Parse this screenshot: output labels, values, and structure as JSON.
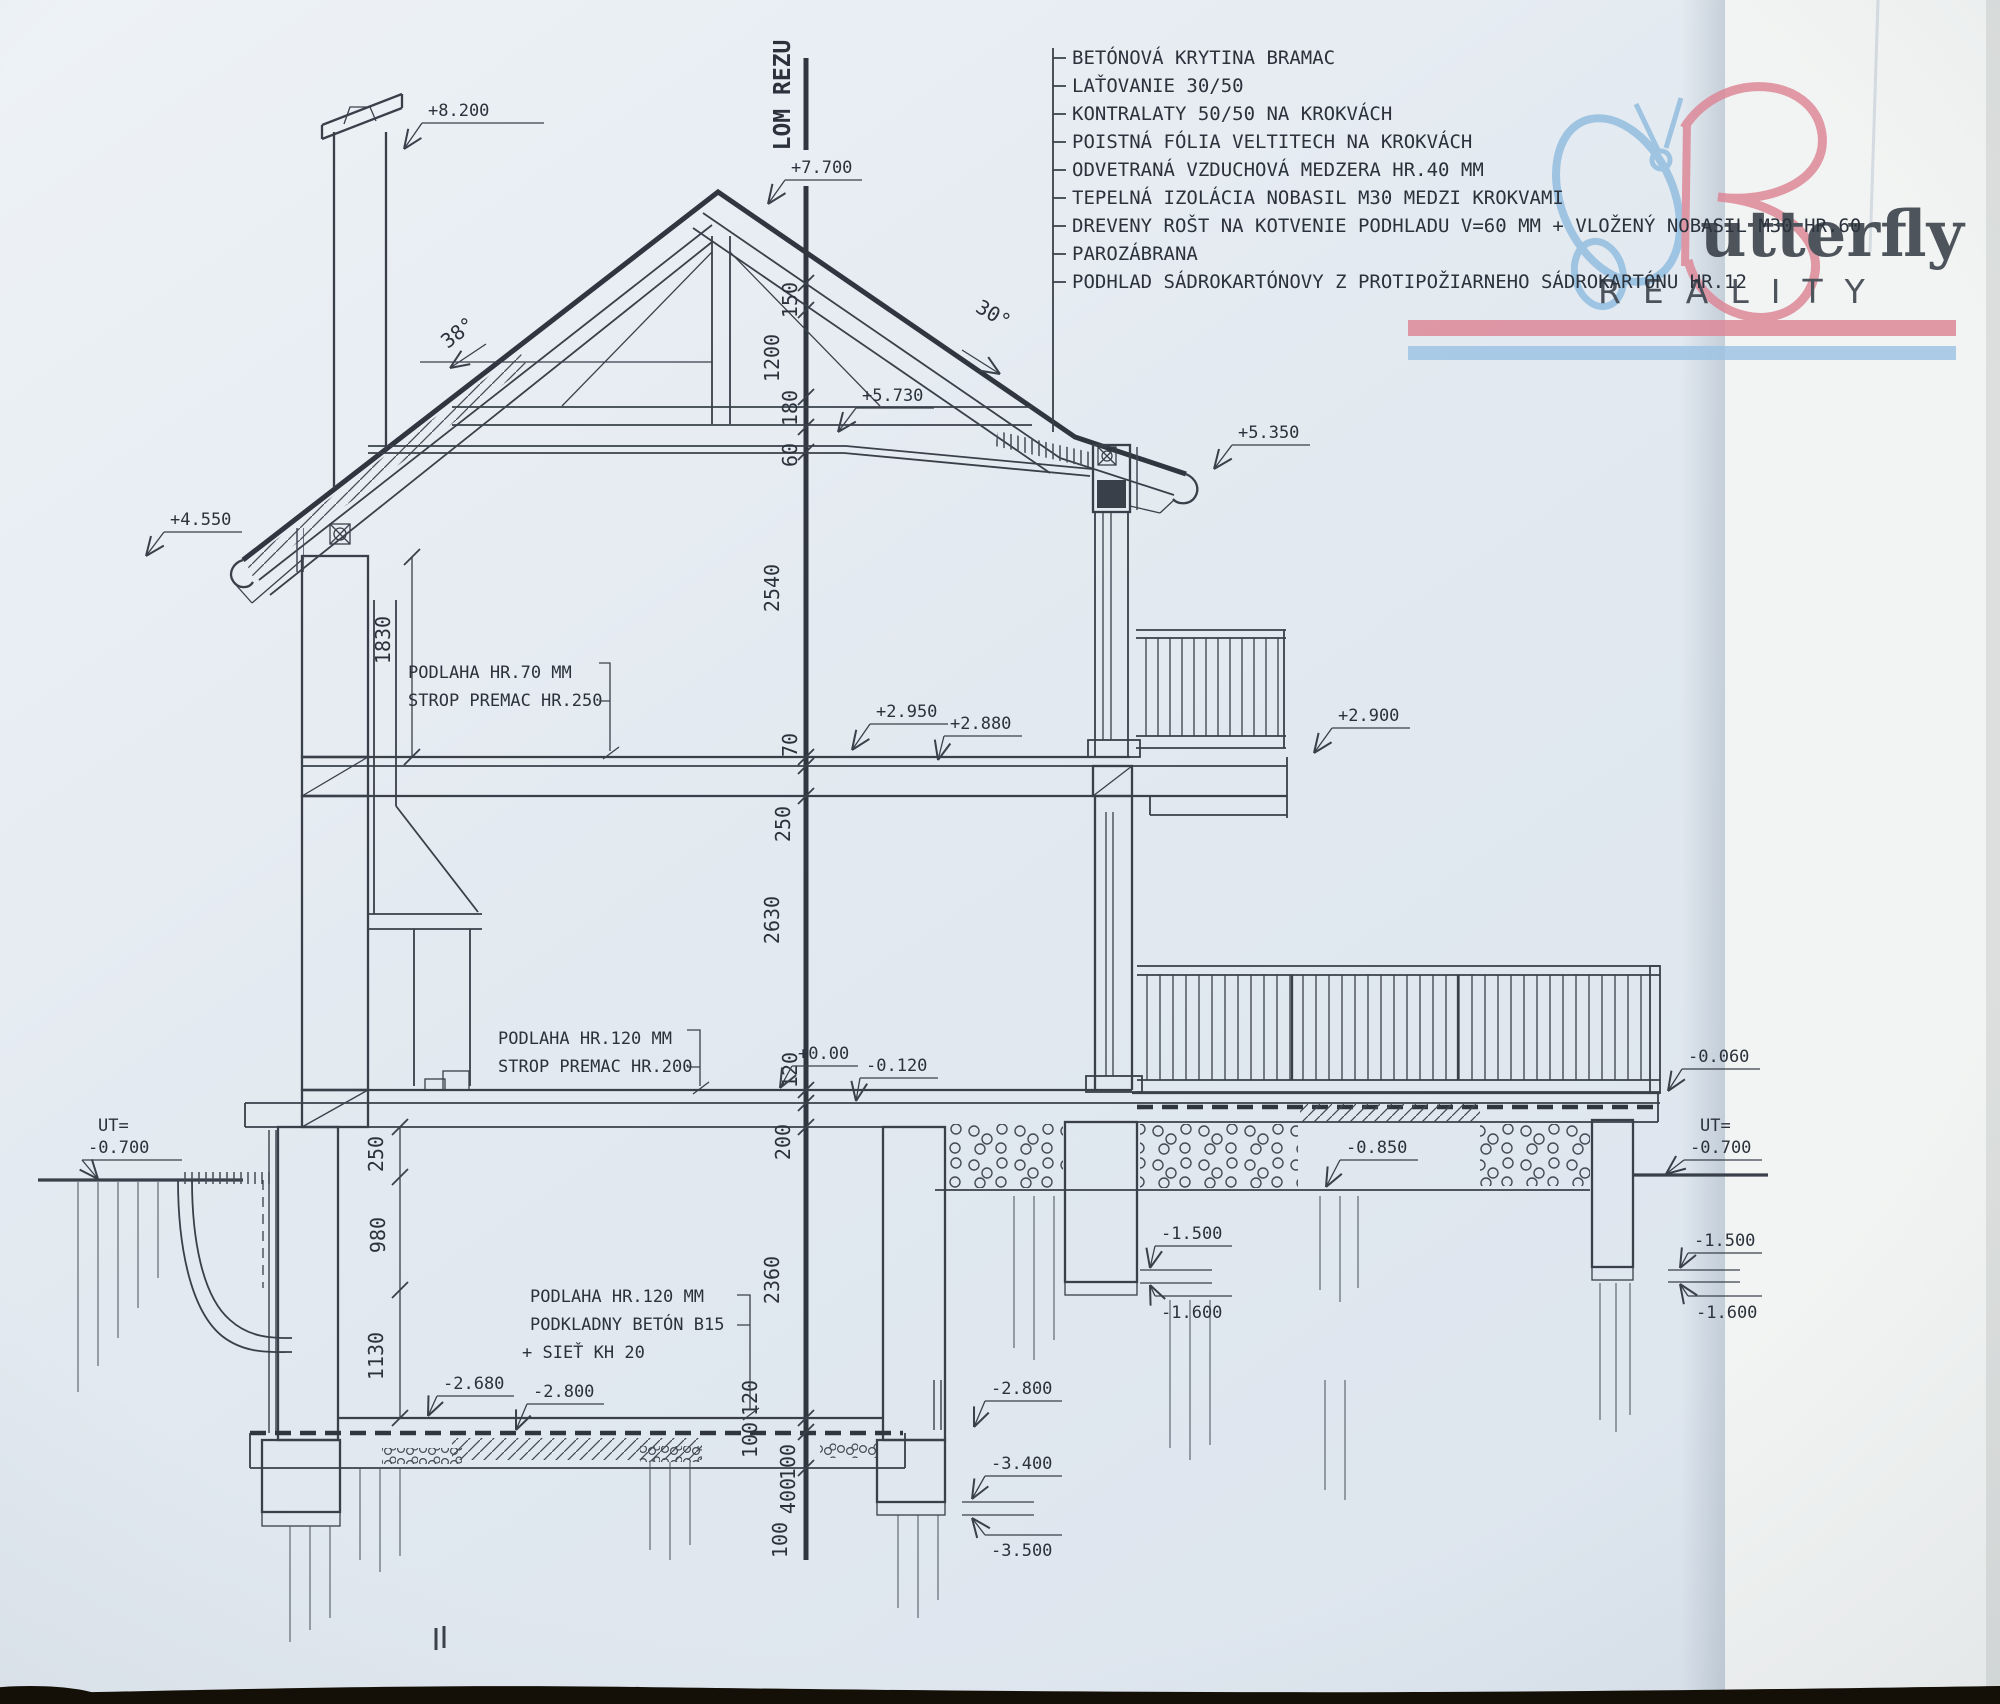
{
  "document": {
    "type": "architectural-section-drawing",
    "section_label": "LOM REZU"
  },
  "colors": {
    "ink": "#39404a",
    "text": "#2b323c",
    "paper": "#e4eaf1",
    "paper_fold": "#f2f4f3",
    "logo_pink": "#dd8595",
    "logo_blue": "#8fbcdf",
    "photo_edge": "#141008"
  },
  "logo": {
    "wordmark": "utterfly",
    "subtitle": "REALITY"
  },
  "roof_layers": [
    "BETÓNOVÁ KRYTINA BRAMAC",
    "LAŤOVANIE 30/50",
    "KONTRALATY 50/50 NA KROKVÁCH",
    "POISTNÁ FÓLIA VELTITECH NA KROKVÁCH",
    "ODVETRANÁ VZDUCHOVÁ MEDZERA HR.40 MM",
    "TEPELNÁ IZOLÁCIA NOBASIL M30 MEDZI KROKVAMI",
    "DREVENY ROŠT NA KOTVENIE PODHLADU V=60 MM + VLOŽENÝ NOBASIL M30 HR.60",
    "PAROZÁBRANA",
    "PODHLAD SÁDROKARTÓNOVY Z PROTIPOŽIARNEHO SÁDROKARTÓNU HR.12"
  ],
  "angles": {
    "left": "38°",
    "right": "30°"
  },
  "levels": {
    "p8200": "+8.200",
    "p7700": "+7.700",
    "p5730": "+5.730",
    "p5350": "+5.350",
    "p4550": "+4.550",
    "p2950": "+2.950",
    "p2880": "+2.880",
    "p2900": "+2.900",
    "zero": "+0.00",
    "m0120": "-0.120",
    "m0060": "-0.060",
    "ut": "UT=",
    "m0700": "-0.700",
    "m0850": "-0.850",
    "m1500": "-1.500",
    "m1600": "-1.600",
    "m2680": "-2.680",
    "m2800": "-2.800",
    "m3400": "-3.400",
    "m3500": "-3.500"
  },
  "floor_notes": {
    "upper": [
      "PODLAHA HR.70 MM",
      "STROP PREMAC HR.250"
    ],
    "ground": [
      "PODLAHA HR.120 MM",
      "STROP PREMAC HR.200"
    ],
    "basement": [
      "PODLAHA HR.120 MM",
      "PODKLADNY BETÓN B15",
      "+ SIEŤ KH 20"
    ]
  },
  "dims": {
    "center": [
      "150",
      "1200",
      "180",
      "60",
      "2540",
      "70",
      "250",
      "2630",
      "120",
      "200",
      "2360",
      "120",
      "100",
      "100",
      "400",
      "100"
    ],
    "left": [
      "1830",
      "250",
      "980",
      "1130"
    ]
  }
}
